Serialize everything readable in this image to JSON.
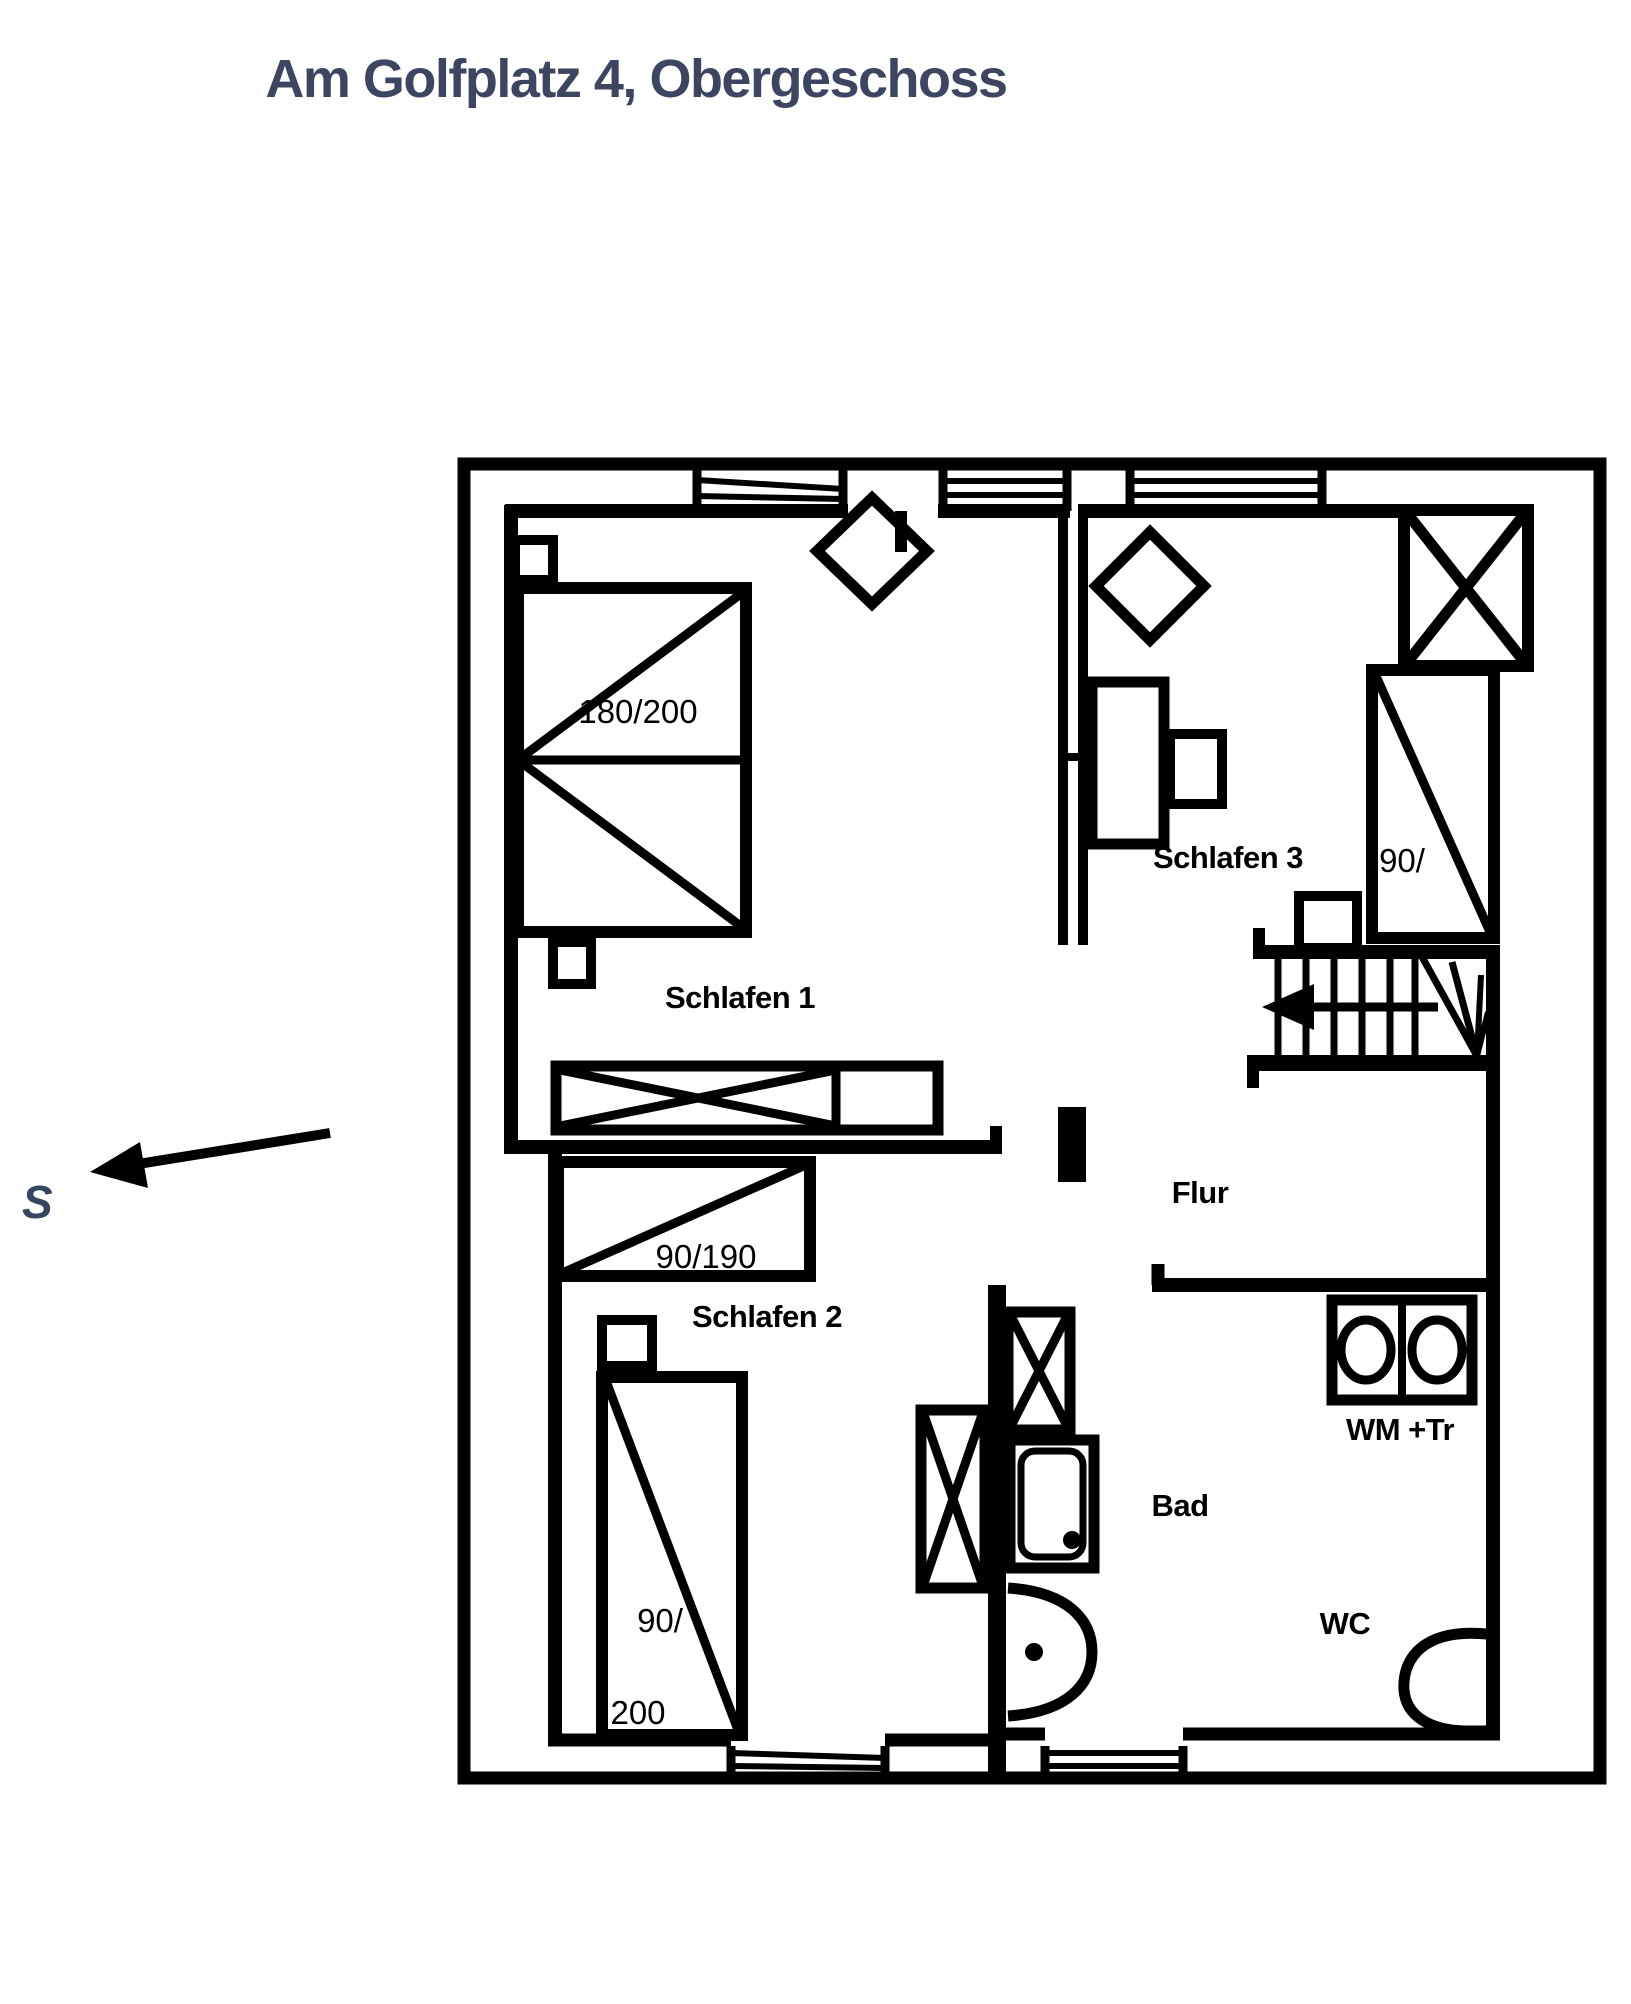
{
  "title": "Am Golfplatz 4, Obergeschoss",
  "compass": {
    "south_label": "S"
  },
  "rooms": {
    "schlafen1": {
      "name": "Schlafen 1",
      "bed": "180/200"
    },
    "schlafen2": {
      "name": "Schlafen 2",
      "bed_single": "90/190",
      "bed_vertical_width": "90/",
      "bed_vertical_length": "200"
    },
    "schlafen3": {
      "name": "Schlafen 3",
      "bed": "90/"
    },
    "flur": {
      "name": "Flur"
    },
    "bad": {
      "name": "Bad",
      "wc": "WC",
      "washer_dryer": "WM +Tr"
    }
  },
  "colors": {
    "title_text": "#3d4560",
    "compass_text": "#35465e",
    "plan_lines": "#000000",
    "background": "#ffffff"
  }
}
